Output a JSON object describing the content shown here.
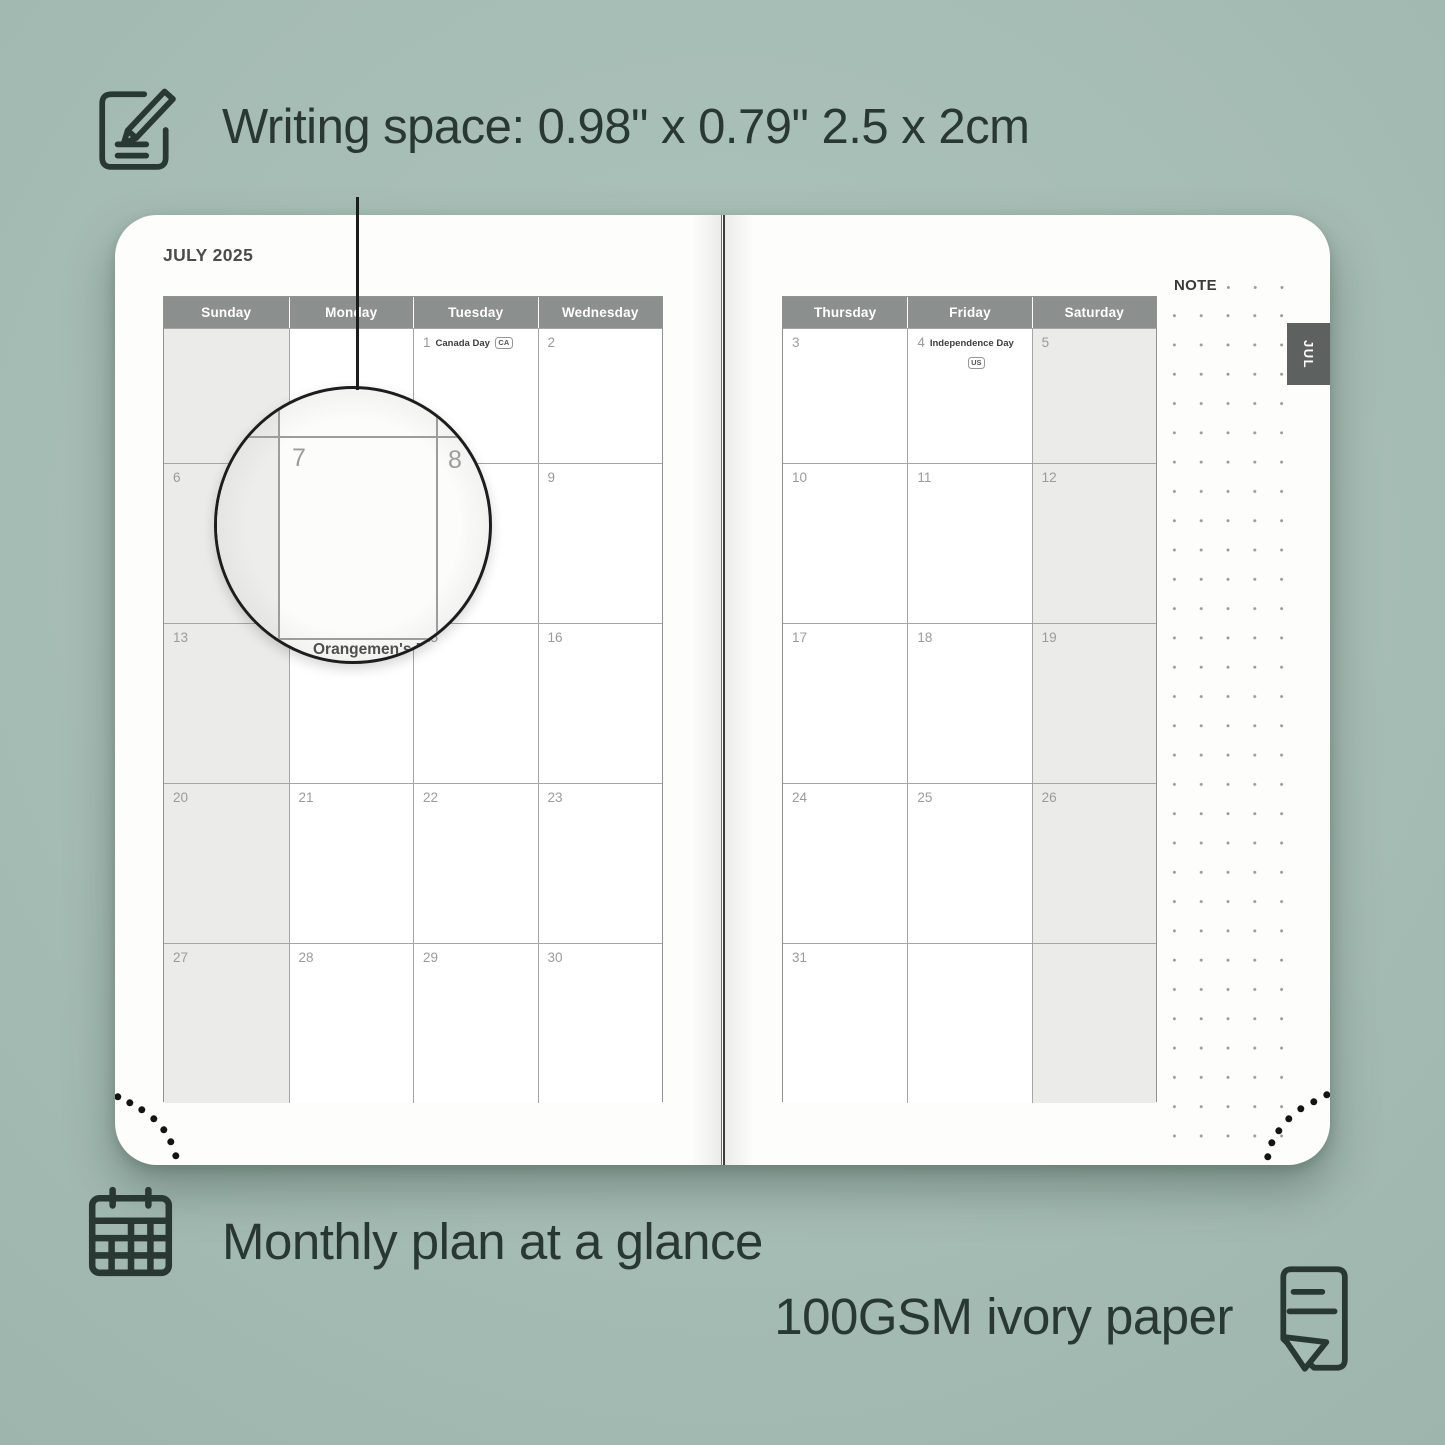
{
  "annotations": {
    "writing_space": "Writing space: 0.98\" x 0.79\" 2.5 x 2cm",
    "monthly_plan": "Monthly plan at a glance",
    "paper": "100GSM ivory paper"
  },
  "icons": {
    "writing": "note-pencil-icon",
    "monthly": "calendar-grid-icon",
    "paper": "paper-sheet-icon"
  },
  "planner": {
    "month_title": "JULY 2025",
    "tab_label": "JUL",
    "note_label": "NOTE",
    "left_page": {
      "day_headers": [
        "Sunday",
        "Monday",
        "Tuesday",
        "Wednesday"
      ],
      "weeks": [
        [
          {
            "day": "",
            "shaded": true
          },
          {
            "day": ""
          },
          {
            "day": "1",
            "holiday": "Canada Day",
            "badge": "CA"
          },
          {
            "day": "2"
          }
        ],
        [
          {
            "day": "6",
            "shaded": true
          },
          {
            "day": "7"
          },
          {
            "day": "8"
          },
          {
            "day": "9"
          }
        ],
        [
          {
            "day": "13",
            "shaded": true
          },
          {
            "day": "14",
            "holiday": "Orangemen's Day"
          },
          {
            "day": "15"
          },
          {
            "day": "16"
          }
        ],
        [
          {
            "day": "20",
            "shaded": true
          },
          {
            "day": "21"
          },
          {
            "day": "22"
          },
          {
            "day": "23"
          }
        ],
        [
          {
            "day": "27",
            "shaded": true
          },
          {
            "day": "28"
          },
          {
            "day": "29"
          },
          {
            "day": "30"
          }
        ]
      ]
    },
    "right_page": {
      "day_headers": [
        "Thursday",
        "Friday",
        "Saturday"
      ],
      "weeks": [
        [
          {
            "day": "3"
          },
          {
            "day": "4",
            "holiday": "Independence Day",
            "badge": "US",
            "badge_below": true
          },
          {
            "day": "5",
            "shaded": true
          }
        ],
        [
          {
            "day": "10"
          },
          {
            "day": "11"
          },
          {
            "day": "12",
            "shaded": true
          }
        ],
        [
          {
            "day": "17"
          },
          {
            "day": "18"
          },
          {
            "day": "19",
            "shaded": true
          }
        ],
        [
          {
            "day": "24"
          },
          {
            "day": "25"
          },
          {
            "day": "26",
            "shaded": true
          }
        ],
        [
          {
            "day": "31"
          },
          {
            "day": ""
          },
          {
            "day": "",
            "shaded": true
          }
        ]
      ]
    },
    "magnifier": {
      "day_left": "7",
      "day_right": "8",
      "clipped_text": "Orangemen's Day"
    }
  },
  "colors": {
    "background": "#a6bdb5",
    "accent_dark": "#2a3833",
    "header_gray": "#8b908e",
    "tab_gray": "#5d615f",
    "shaded_cell": "#ebebea",
    "grid_line": "#a6a6a6"
  }
}
